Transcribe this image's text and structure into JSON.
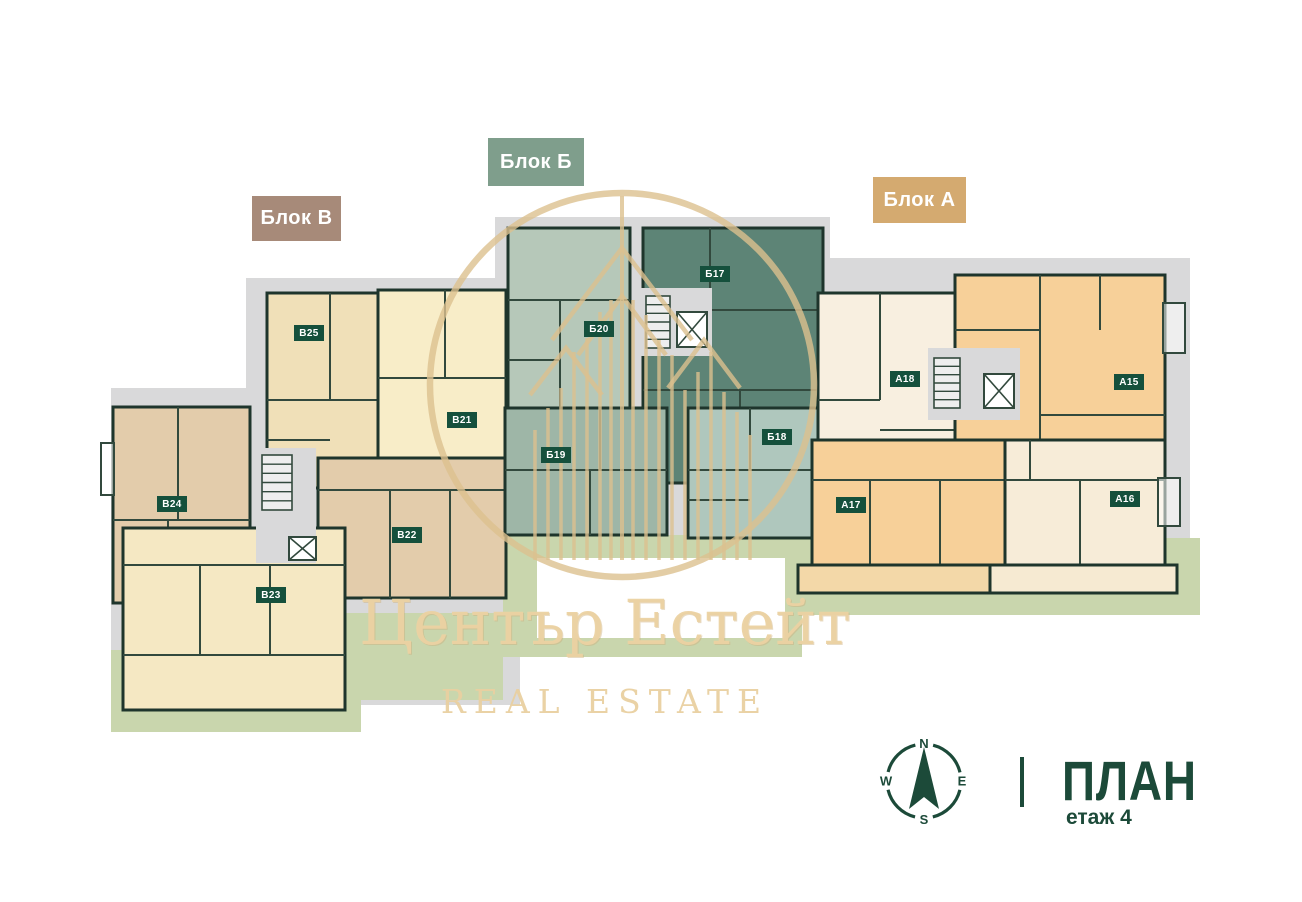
{
  "canvas": {
    "width": 1302,
    "height": 902,
    "background": "#ffffff"
  },
  "colors": {
    "footprint": "#d9d9da",
    "lawn": "#c9d6ad",
    "wall": "#1e352c",
    "inner_wall": "#32493d",
    "badge_bg": "#15503c",
    "badge_text": "#ffffff",
    "accent_green": "#1c4a39",
    "watermark_gold": "#ebd2a2",
    "logo_gold": "#dcc08f",
    "block_v": "#a78a79",
    "block_b": "#7f9e8c",
    "block_a": "#d4aa70"
  },
  "block_labels": [
    {
      "id": "v",
      "text": "Блок В",
      "bg": "#a78a79"
    },
    {
      "id": "b",
      "text": "Блок Б",
      "bg": "#7f9e8c"
    },
    {
      "id": "a",
      "text": "Блок А",
      "bg": "#d4aa70"
    }
  ],
  "plan": {
    "footprints": [
      {
        "x": 246,
        "y": 278,
        "w": 274,
        "h": 62
      },
      {
        "x": 246,
        "y": 340,
        "w": 274,
        "h": 60
      },
      {
        "x": 111,
        "y": 388,
        "w": 409,
        "h": 317
      },
      {
        "x": 495,
        "y": 217,
        "w": 335,
        "h": 348
      },
      {
        "x": 808,
        "y": 258,
        "w": 382,
        "h": 345
      }
    ],
    "lawns": [
      {
        "x": 111,
        "y": 650,
        "w": 250,
        "h": 82
      },
      {
        "x": 345,
        "y": 613,
        "w": 158,
        "h": 87
      },
      {
        "x": 503,
        "y": 535,
        "w": 299,
        "h": 122
      },
      {
        "x": 783,
        "y": 538,
        "w": 417,
        "h": 77
      },
      {
        "x": 786,
        "y": 370,
        "w": 18,
        "h": 175
      }
    ],
    "white_patch": {
      "x": 537,
      "y": 558,
      "w": 248,
      "h": 80
    },
    "units": [
      {
        "id": "B25",
        "label": "В25",
        "x": 267,
        "y": 293,
        "w": 113,
        "h": 195,
        "fill": "#f0e0b8",
        "badge": {
          "x": 294,
          "y": 325
        },
        "lines": [
          [
            330,
            293,
            330,
            400
          ],
          [
            267,
            400,
            380,
            400
          ],
          [
            267,
            440,
            330,
            440
          ]
        ]
      },
      {
        "id": "B21",
        "label": "В21",
        "x": 378,
        "y": 290,
        "w": 128,
        "h": 257,
        "fill": "#f8edc8",
        "badge": {
          "x": 447,
          "y": 412
        },
        "lines": [
          [
            445,
            290,
            445,
            378
          ],
          [
            378,
            378,
            506,
            378
          ],
          [
            378,
            465,
            506,
            465
          ],
          [
            440,
            465,
            440,
            547
          ]
        ]
      },
      {
        "id": "B24",
        "label": "В24",
        "x": 113,
        "y": 407,
        "w": 137,
        "h": 196,
        "fill": "#e3ccab",
        "badge": {
          "x": 157,
          "y": 496
        },
        "lines": [
          [
            178,
            407,
            178,
            520
          ],
          [
            113,
            520,
            250,
            520
          ],
          [
            168,
            520,
            168,
            603
          ]
        ]
      },
      {
        "id": "B22",
        "label": "В22",
        "x": 318,
        "y": 458,
        "w": 188,
        "h": 140,
        "fill": "#e3ccab",
        "badge": {
          "x": 392,
          "y": 527
        },
        "lines": [
          [
            318,
            490,
            506,
            490
          ],
          [
            390,
            490,
            390,
            598
          ],
          [
            450,
            490,
            450,
            598
          ]
        ]
      },
      {
        "id": "B23",
        "label": "В23",
        "x": 123,
        "y": 528,
        "w": 222,
        "h": 182,
        "fill": "#f5e8c3",
        "badge": {
          "x": 256,
          "y": 587
        },
        "lines": [
          [
            123,
            565,
            345,
            565
          ],
          [
            200,
            565,
            200,
            655
          ],
          [
            270,
            565,
            270,
            655
          ],
          [
            123,
            655,
            345,
            655
          ]
        ]
      },
      {
        "id": "B20",
        "label": "Б20",
        "x": 508,
        "y": 228,
        "w": 122,
        "h": 180,
        "fill": "#b6c8b9",
        "badge": {
          "x": 584,
          "y": 321
        },
        "lines": [
          [
            508,
            300,
            630,
            300
          ],
          [
            560,
            300,
            560,
            408
          ],
          [
            508,
            360,
            560,
            360
          ]
        ]
      },
      {
        "id": "B17",
        "label": "Б17",
        "x": 643,
        "y": 228,
        "w": 180,
        "h": 255,
        "fill": "#5d8476",
        "badge": {
          "x": 700,
          "y": 266
        },
        "lines": [
          [
            710,
            228,
            710,
            310
          ],
          [
            710,
            310,
            823,
            310
          ],
          [
            643,
            390,
            823,
            390
          ],
          [
            740,
            390,
            740,
            483
          ]
        ]
      },
      {
        "id": "B19",
        "label": "Б19",
        "x": 505,
        "y": 408,
        "w": 162,
        "h": 127,
        "fill": "#9eb6a7",
        "badge": {
          "x": 541,
          "y": 447
        },
        "lines": [
          [
            505,
            470,
            667,
            470
          ],
          [
            590,
            470,
            590,
            535
          ],
          [
            600,
            408,
            600,
            470
          ]
        ]
      },
      {
        "id": "B18",
        "label": "Б18",
        "x": 688,
        "y": 408,
        "w": 132,
        "h": 130,
        "fill": "#afc7bd",
        "badge": {
          "x": 762,
          "y": 429
        },
        "lines": [
          [
            750,
            408,
            750,
            470
          ],
          [
            688,
            470,
            820,
            470
          ],
          [
            688,
            500,
            750,
            500
          ]
        ]
      },
      {
        "id": "A18",
        "label": "А18",
        "x": 818,
        "y": 293,
        "w": 157,
        "h": 180,
        "fill": "#f8efe0",
        "badge": {
          "x": 890,
          "y": 371
        },
        "lines": [
          [
            880,
            293,
            880,
            400
          ],
          [
            818,
            400,
            880,
            400
          ],
          [
            880,
            430,
            975,
            430
          ]
        ]
      },
      {
        "id": "A15",
        "label": "А15",
        "x": 955,
        "y": 275,
        "w": 210,
        "h": 165,
        "fill": "#f7d099",
        "badge": {
          "x": 1114,
          "y": 374
        },
        "lines": [
          [
            1040,
            275,
            1040,
            440
          ],
          [
            1040,
            415,
            1165,
            415
          ],
          [
            955,
            330,
            1040,
            330
          ],
          [
            1100,
            275,
            1100,
            330
          ]
        ]
      },
      {
        "id": "A17",
        "label": "А17",
        "x": 812,
        "y": 440,
        "w": 193,
        "h": 125,
        "fill": "#f7d099",
        "badge": {
          "x": 836,
          "y": 497
        },
        "lines": [
          [
            812,
            480,
            1005,
            480
          ],
          [
            870,
            480,
            870,
            565
          ],
          [
            940,
            480,
            940,
            565
          ]
        ]
      },
      {
        "id": "A16",
        "label": "А16",
        "x": 1005,
        "y": 440,
        "w": 160,
        "h": 125,
        "fill": "#f7ecd8",
        "badge": {
          "x": 1110,
          "y": 491
        },
        "lines": [
          [
            1005,
            480,
            1165,
            480
          ],
          [
            1080,
            480,
            1080,
            565
          ],
          [
            1030,
            440,
            1030,
            480
          ]
        ]
      }
    ],
    "stairwells": [
      {
        "box": {
          "x": 256,
          "y": 448,
          "w": 60,
          "h": 115
        },
        "stairs": {
          "x": 262,
          "y": 455,
          "w": 30,
          "h": 55
        },
        "elevator": {
          "x": 289,
          "y": 537,
          "w": 27,
          "h": 23
        }
      },
      {
        "box": {
          "x": 640,
          "y": 288,
          "w": 72,
          "h": 68
        },
        "stairs": {
          "x": 646,
          "y": 296,
          "w": 24,
          "h": 52
        },
        "elevator": {
          "x": 677,
          "y": 312,
          "w": 30,
          "h": 35
        }
      },
      {
        "box": {
          "x": 928,
          "y": 348,
          "w": 92,
          "h": 72
        },
        "stairs": {
          "x": 934,
          "y": 358,
          "w": 26,
          "h": 50
        },
        "elevator": {
          "x": 984,
          "y": 374,
          "w": 30,
          "h": 34
        }
      }
    ],
    "terraces": [
      {
        "x": 798,
        "y": 565,
        "w": 192,
        "h": 28,
        "fill": "#f3d8a8"
      },
      {
        "x": 990,
        "y": 565,
        "w": 187,
        "h": 28,
        "fill": "#f6ead2"
      }
    ],
    "balconies": [
      {
        "x": 1163,
        "y": 303,
        "w": 22,
        "h": 50
      },
      {
        "x": 1158,
        "y": 478,
        "w": 22,
        "h": 48
      },
      {
        "x": 101,
        "y": 443,
        "w": 13,
        "h": 52
      }
    ],
    "logo": {
      "cx": 622,
      "cy": 385,
      "r": 192,
      "center_line": [
        622,
        196,
        622,
        560
      ],
      "roofs": [
        "M552,340 L622,248 L692,340",
        "M578,355 L622,296 L666,355",
        "M530,395 L566,348 L602,395",
        "M668,388 L704,340 L740,388"
      ],
      "columns_y2": 560,
      "columns": [
        [
          535,
          430
        ],
        [
          548,
          408
        ],
        [
          561,
          388
        ],
        [
          574,
          352
        ],
        [
          587,
          338
        ],
        [
          600,
          312
        ],
        [
          611,
          300
        ],
        [
          633,
          300
        ],
        [
          646,
          315
        ],
        [
          659,
          340
        ],
        [
          672,
          355
        ],
        [
          685,
          390
        ],
        [
          698,
          372
        ],
        [
          711,
          352
        ],
        [
          724,
          392
        ],
        [
          737,
          412
        ],
        [
          750,
          435
        ]
      ]
    }
  },
  "compass": {
    "n": "N",
    "e": "E",
    "s": "S",
    "w": "W"
  },
  "watermark": {
    "title": "Център Естейт",
    "subtitle": "REAL ESTATE"
  },
  "legend": {
    "separator": "|",
    "title": "ПЛАН",
    "floor": "етаж 4"
  }
}
